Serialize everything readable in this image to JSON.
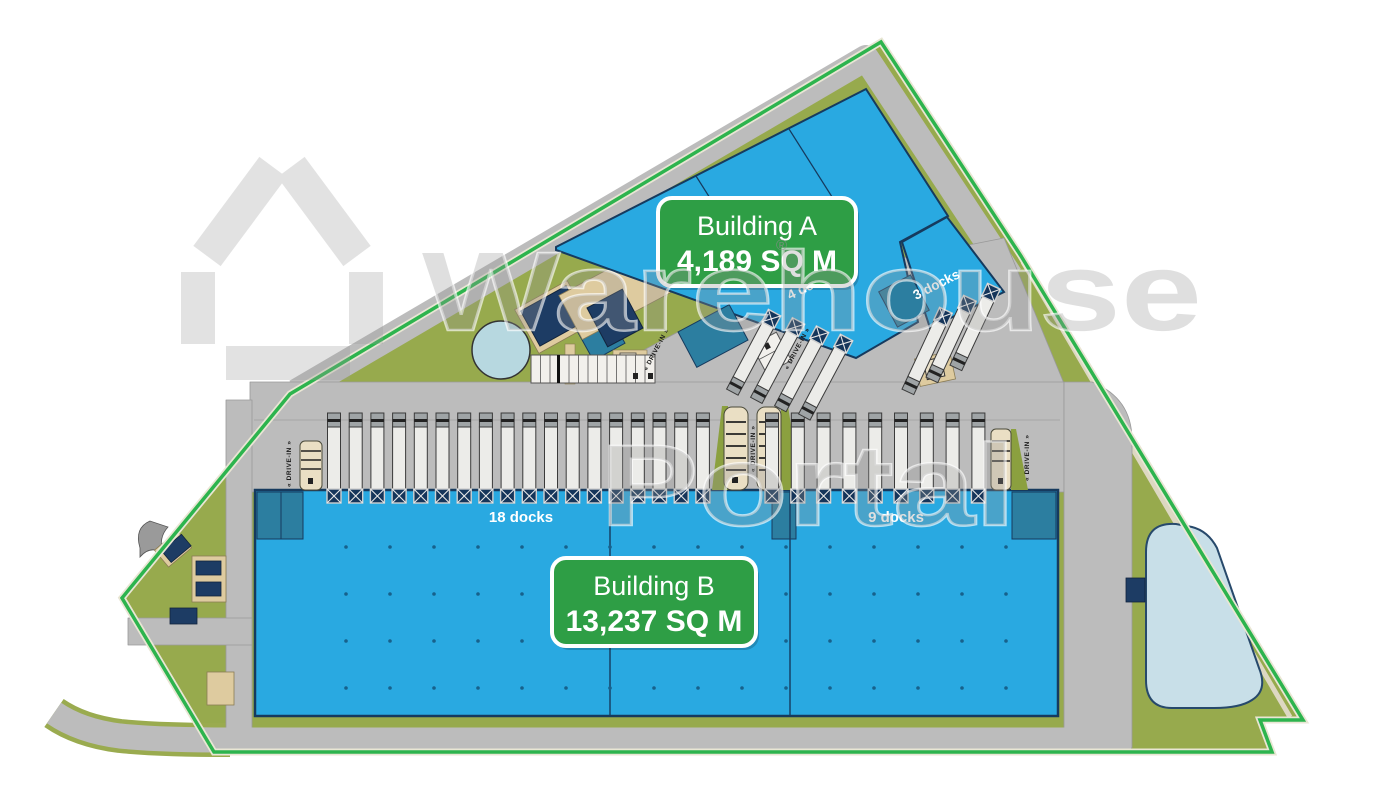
{
  "watermark": {
    "brand_word1": "Warehouse",
    "brand_word2": "Portal",
    "registered": "®",
    "logo": "warehouse-house-pentagon-logo"
  },
  "labels": {
    "building_a": {
      "title": "Building A",
      "area": "4,189 SQ M"
    },
    "building_b": {
      "title": "Building B",
      "area": "13,237 SQ M"
    }
  },
  "docks": {
    "building_b_left": {
      "label": "18 docks",
      "count": 18
    },
    "building_b_right": {
      "label": "9 docks",
      "count": 9
    },
    "building_a_right": {
      "label": "3 docks",
      "count": 3
    },
    "building_a_left": {
      "label": "4 docks",
      "count": 4
    }
  },
  "road_labels": {
    "drive_in": "« DRIVE-IN »"
  },
  "colors": {
    "building_fill": "#29a9e1",
    "building_dark_corner": "#2c7ea0",
    "label_green": "#2e9e45",
    "boundary_green": "#2db44e",
    "grass": "#97aa4d",
    "road_gray": "#bcbcbc",
    "navy_structure": "#1d3c64",
    "dock_door_navy": "#15355a",
    "pond_blue": "#c8dfe8",
    "column_dot": "#17618c"
  }
}
